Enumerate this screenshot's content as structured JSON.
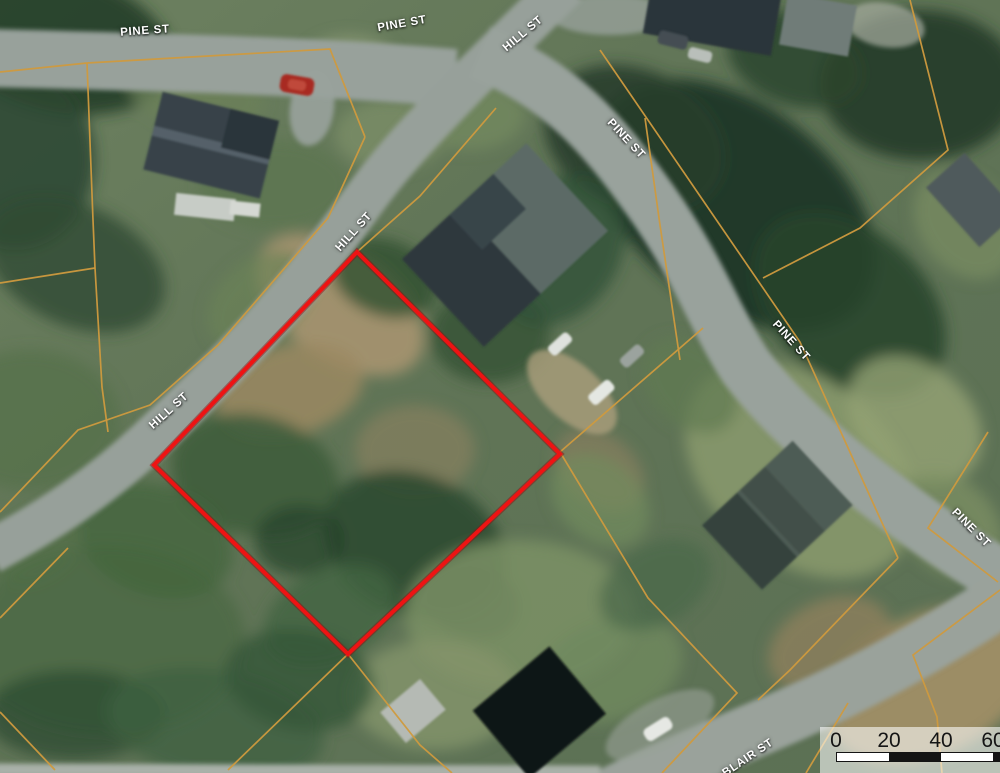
{
  "map": {
    "street_labels": [
      {
        "text": "PINE ST",
        "x": 145,
        "y": 31,
        "angle": -4
      },
      {
        "text": "PINE ST",
        "x": 402,
        "y": 24,
        "angle": -10
      },
      {
        "text": "HILL ST",
        "x": 523,
        "y": 34,
        "angle": -40
      },
      {
        "text": "PINE ST",
        "x": 626,
        "y": 139,
        "angle": 47
      },
      {
        "text": "HILL ST",
        "x": 354,
        "y": 232,
        "angle": -48
      },
      {
        "text": "PINE ST",
        "x": 791,
        "y": 341,
        "angle": 48
      },
      {
        "text": "HILL ST",
        "x": 169,
        "y": 411,
        "angle": -42
      },
      {
        "text": "PINE ST",
        "x": 971,
        "y": 528,
        "angle": 45
      },
      {
        "text": "BLAIR ST",
        "x": 748,
        "y": 758,
        "angle": -34
      }
    ],
    "subject_parcel": {
      "points": "357,252 560,454 348,654 154,465",
      "color": "#ee1313",
      "halo_color": "#8f0d0d"
    },
    "parcel_lines": {
      "color": "#cf9a3e",
      "polylines": [
        "0,72 87,63 330,49 365,137",
        "87,63 93,220 95,268 102,387 108,432",
        "95,268 0,283",
        "365,137 328,218 218,345 150,405 78,430 0,512",
        "496,108 420,196 357,252",
        "703,328 560,452",
        "560,452 648,598 737,693 662,773",
        "348,654 228,770",
        "348,654 420,745 452,773",
        "0,712 55,770",
        "0,618 68,548",
        "600,50 700,196 800,342 898,558",
        "910,0 948,150 860,228 763,278",
        "898,558 790,670 758,700",
        "1000,590 913,655 937,717 942,773",
        "848,703 806,773",
        "988,432 928,528 998,582",
        "645,118 660,225 680,360"
      ]
    },
    "colors": {
      "road": "#98a19b",
      "label_text": "#ffffff"
    }
  },
  "scale_bar": {
    "x": 820,
    "y": 727,
    "width": 190,
    "height": 50,
    "background": "rgba(255,255,255,0.58)",
    "ticks": [
      {
        "label": "0",
        "cx": 16
      },
      {
        "label": "20",
        "cx": 69
      },
      {
        "label": "40",
        "cx": 121
      },
      {
        "label": "60",
        "cx": 173
      }
    ],
    "bar": {
      "left": 16,
      "top": 25,
      "height": 8,
      "segments": [
        {
          "w": 52,
          "color": "#ffffff"
        },
        {
          "w": 52,
          "color": "#141414"
        },
        {
          "w": 52,
          "color": "#ffffff"
        },
        {
          "w": 18,
          "color": "#141414"
        }
      ]
    }
  }
}
